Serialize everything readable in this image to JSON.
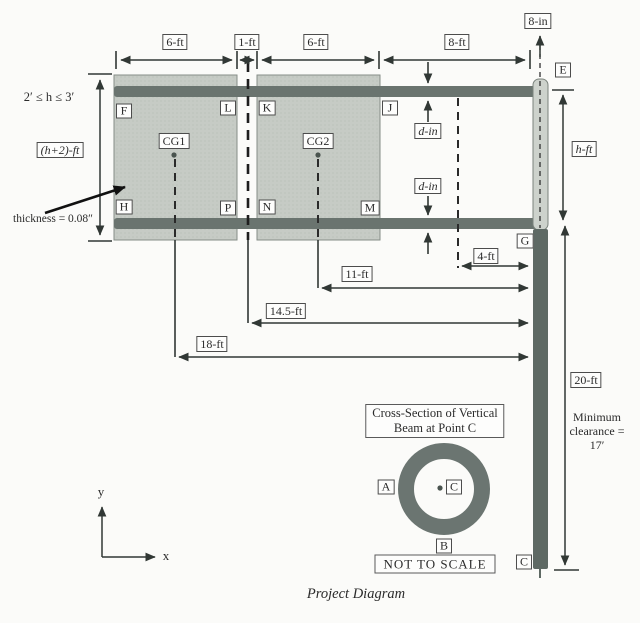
{
  "diagram_title": "Project Diagram",
  "dims": {
    "panel1_width": "6-ft",
    "panel_gap": "1-ft",
    "panel2_width": "6-ft",
    "overhang": "8-ft",
    "post_offset": "8-in",
    "sign_height": "(h+2)-ft",
    "beam_dia_upper": "d-in",
    "beam_dia_lower": "d-in",
    "mid_to_post": "4-ft",
    "cg2_to_post": "11-ft",
    "gap_to_post": "14.5-ft",
    "cg1_to_post": "18-ft",
    "post_height": "20-ft",
    "clear_height": "h-ft"
  },
  "notes": {
    "h_range": "2′ ≤ h ≤ 3′",
    "thickness": "thickness = 0.08″",
    "min_clearance": "Minimum clearance = 17′",
    "not_to_scale": "NOT TO SCALE"
  },
  "points": {
    "F": "F",
    "L": "L",
    "K": "K",
    "J": "J",
    "H": "H",
    "P": "P",
    "N": "N",
    "M": "M",
    "E": "E",
    "G": "G",
    "C_base": "C"
  },
  "centroids": {
    "cg1": "CG1",
    "cg2": "CG2"
  },
  "cross_section": {
    "title_line1": "Cross-Section of Vertical",
    "title_line2": "Beam at Point C",
    "left_label": "A",
    "bottom_label": "B",
    "center_label": "C"
  },
  "axes": {
    "x_label": "x",
    "y_label": "y"
  },
  "colors": {
    "panel": "#c6cbc5",
    "beam": "#6a746f",
    "post_dark": "#5e6964",
    "line": "#313835",
    "background": "#fbfbf9"
  }
}
